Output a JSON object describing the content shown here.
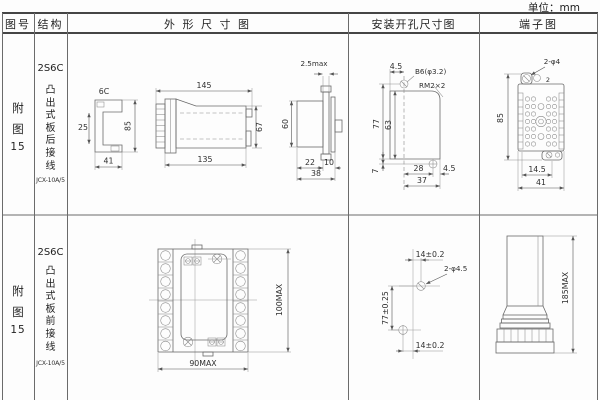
{
  "unit_label": "单位：mm",
  "colors": {
    "line": "#666666",
    "grid": "#4a4a4a",
    "text": "#333333",
    "background": "#ffffff"
  },
  "headers": {
    "figure": "图号",
    "structure": "结构",
    "outline": "外 形 尺 寸 图",
    "mounting": "安装开孔尺寸图",
    "terminal": "端子图"
  },
  "rows": [
    {
      "figure_char1": "附",
      "figure_char2": "图",
      "figure_num": "15",
      "model": "2S6C",
      "desc": "凸出式板后接线",
      "code": "JCX-10A/5",
      "outline": {
        "side_label": "6C",
        "d_25": "25",
        "d_85": "85",
        "d_41": "41",
        "d_145": "145",
        "d_135": "135",
        "d_67": "67",
        "d_25max": "2.5max",
        "d_60": "60",
        "d_22": "22",
        "d_10": "10",
        "d_38": "38"
      },
      "mounting": {
        "d_45_top": "4.5",
        "hole_label": "B6(φ3.2)",
        "corner_label": "RM2×2",
        "d_77": "77",
        "d_63": "63",
        "d_7": "7",
        "d_28": "28",
        "d_37": "37",
        "d_45_right": "4.5"
      },
      "terminal": {
        "hole_label": "2-φ4",
        "tab_label": "2",
        "d_85": "85",
        "d_14_5": "14.5",
        "d_41": "41"
      }
    },
    {
      "figure_char1": "附",
      "figure_char2": "图",
      "figure_num": "15",
      "model": "2S6C",
      "desc": "凸出式板前接线",
      "code": "JCX-10A/5",
      "outline": {
        "d_90": "90MAX",
        "d_100": "100MAX"
      },
      "mounting": {
        "d_14_top": "14±0.2",
        "hole_label": "2-φ4.5",
        "d_77": "77±0.25",
        "d_14_bottom": "14±0.2"
      },
      "terminal": {
        "d_185": "185MAX"
      }
    }
  ]
}
